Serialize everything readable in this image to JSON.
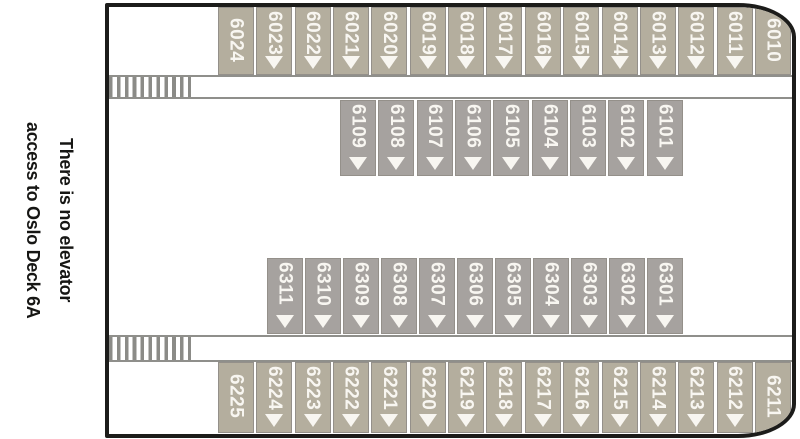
{
  "note": {
    "line1": "There is no elevator",
    "line2": "access to Oslo Deck 6A"
  },
  "colors": {
    "outer_cabin": "#b4ae9e",
    "inner_cabin": "#a6a29f",
    "hull_border": "#1c1c1a",
    "corridor_line": "#8f8f8b",
    "stair_stripe": "#8b8b87",
    "cabin_border": "#94908a",
    "cabin_number_text": "#f8f6f1",
    "note_text": "#161614"
  },
  "deck": {
    "stairs": [
      {
        "icon": "staircase-icon",
        "location": "forward-upper-corridor"
      },
      {
        "icon": "staircase-icon",
        "location": "forward-lower-corridor"
      }
    ],
    "rows": [
      {
        "id": "outer-top",
        "cabins": [
          {
            "number": "6024",
            "arrow": false
          },
          {
            "number": "6023",
            "arrow": true
          },
          {
            "number": "6022",
            "arrow": true
          },
          {
            "number": "6021",
            "arrow": true
          },
          {
            "number": "6020",
            "arrow": true
          },
          {
            "number": "6019",
            "arrow": true
          },
          {
            "number": "6018",
            "arrow": true
          },
          {
            "number": "6017",
            "arrow": true
          },
          {
            "number": "6016",
            "arrow": true
          },
          {
            "number": "6015",
            "arrow": true
          },
          {
            "number": "6014",
            "arrow": true
          },
          {
            "number": "6013",
            "arrow": true
          },
          {
            "number": "6012",
            "arrow": true
          },
          {
            "number": "6011",
            "arrow": true
          },
          {
            "number": "6010",
            "arrow": false
          }
        ]
      },
      {
        "id": "inner-upper",
        "cabins": [
          {
            "number": "6109",
            "arrow": true
          },
          {
            "number": "6108",
            "arrow": true
          },
          {
            "number": "6107",
            "arrow": true
          },
          {
            "number": "6106",
            "arrow": true
          },
          {
            "number": "6105",
            "arrow": true
          },
          {
            "number": "6104",
            "arrow": true
          },
          {
            "number": "6103",
            "arrow": true
          },
          {
            "number": "6102",
            "arrow": true
          },
          {
            "number": "6101",
            "arrow": true
          }
        ]
      },
      {
        "id": "inner-lower",
        "cabins": [
          {
            "number": "6311",
            "arrow": true
          },
          {
            "number": "6310",
            "arrow": true
          },
          {
            "number": "6309",
            "arrow": true
          },
          {
            "number": "6308",
            "arrow": true
          },
          {
            "number": "6307",
            "arrow": true
          },
          {
            "number": "6306",
            "arrow": true
          },
          {
            "number": "6305",
            "arrow": true
          },
          {
            "number": "6304",
            "arrow": true
          },
          {
            "number": "6303",
            "arrow": true
          },
          {
            "number": "6302",
            "arrow": true
          },
          {
            "number": "6301",
            "arrow": true
          }
        ]
      },
      {
        "id": "outer-bottom",
        "cabins": [
          {
            "number": "6225",
            "arrow": false
          },
          {
            "number": "6224",
            "arrow": true
          },
          {
            "number": "6223",
            "arrow": true
          },
          {
            "number": "6222",
            "arrow": true
          },
          {
            "number": "6221",
            "arrow": true
          },
          {
            "number": "6220",
            "arrow": true
          },
          {
            "number": "6219",
            "arrow": true
          },
          {
            "number": "6218",
            "arrow": true
          },
          {
            "number": "6217",
            "arrow": true
          },
          {
            "number": "6216",
            "arrow": true
          },
          {
            "number": "6215",
            "arrow": true
          },
          {
            "number": "6214",
            "arrow": true
          },
          {
            "number": "6213",
            "arrow": true
          },
          {
            "number": "6212",
            "arrow": true
          },
          {
            "number": "6211",
            "arrow": false
          }
        ]
      }
    ]
  }
}
